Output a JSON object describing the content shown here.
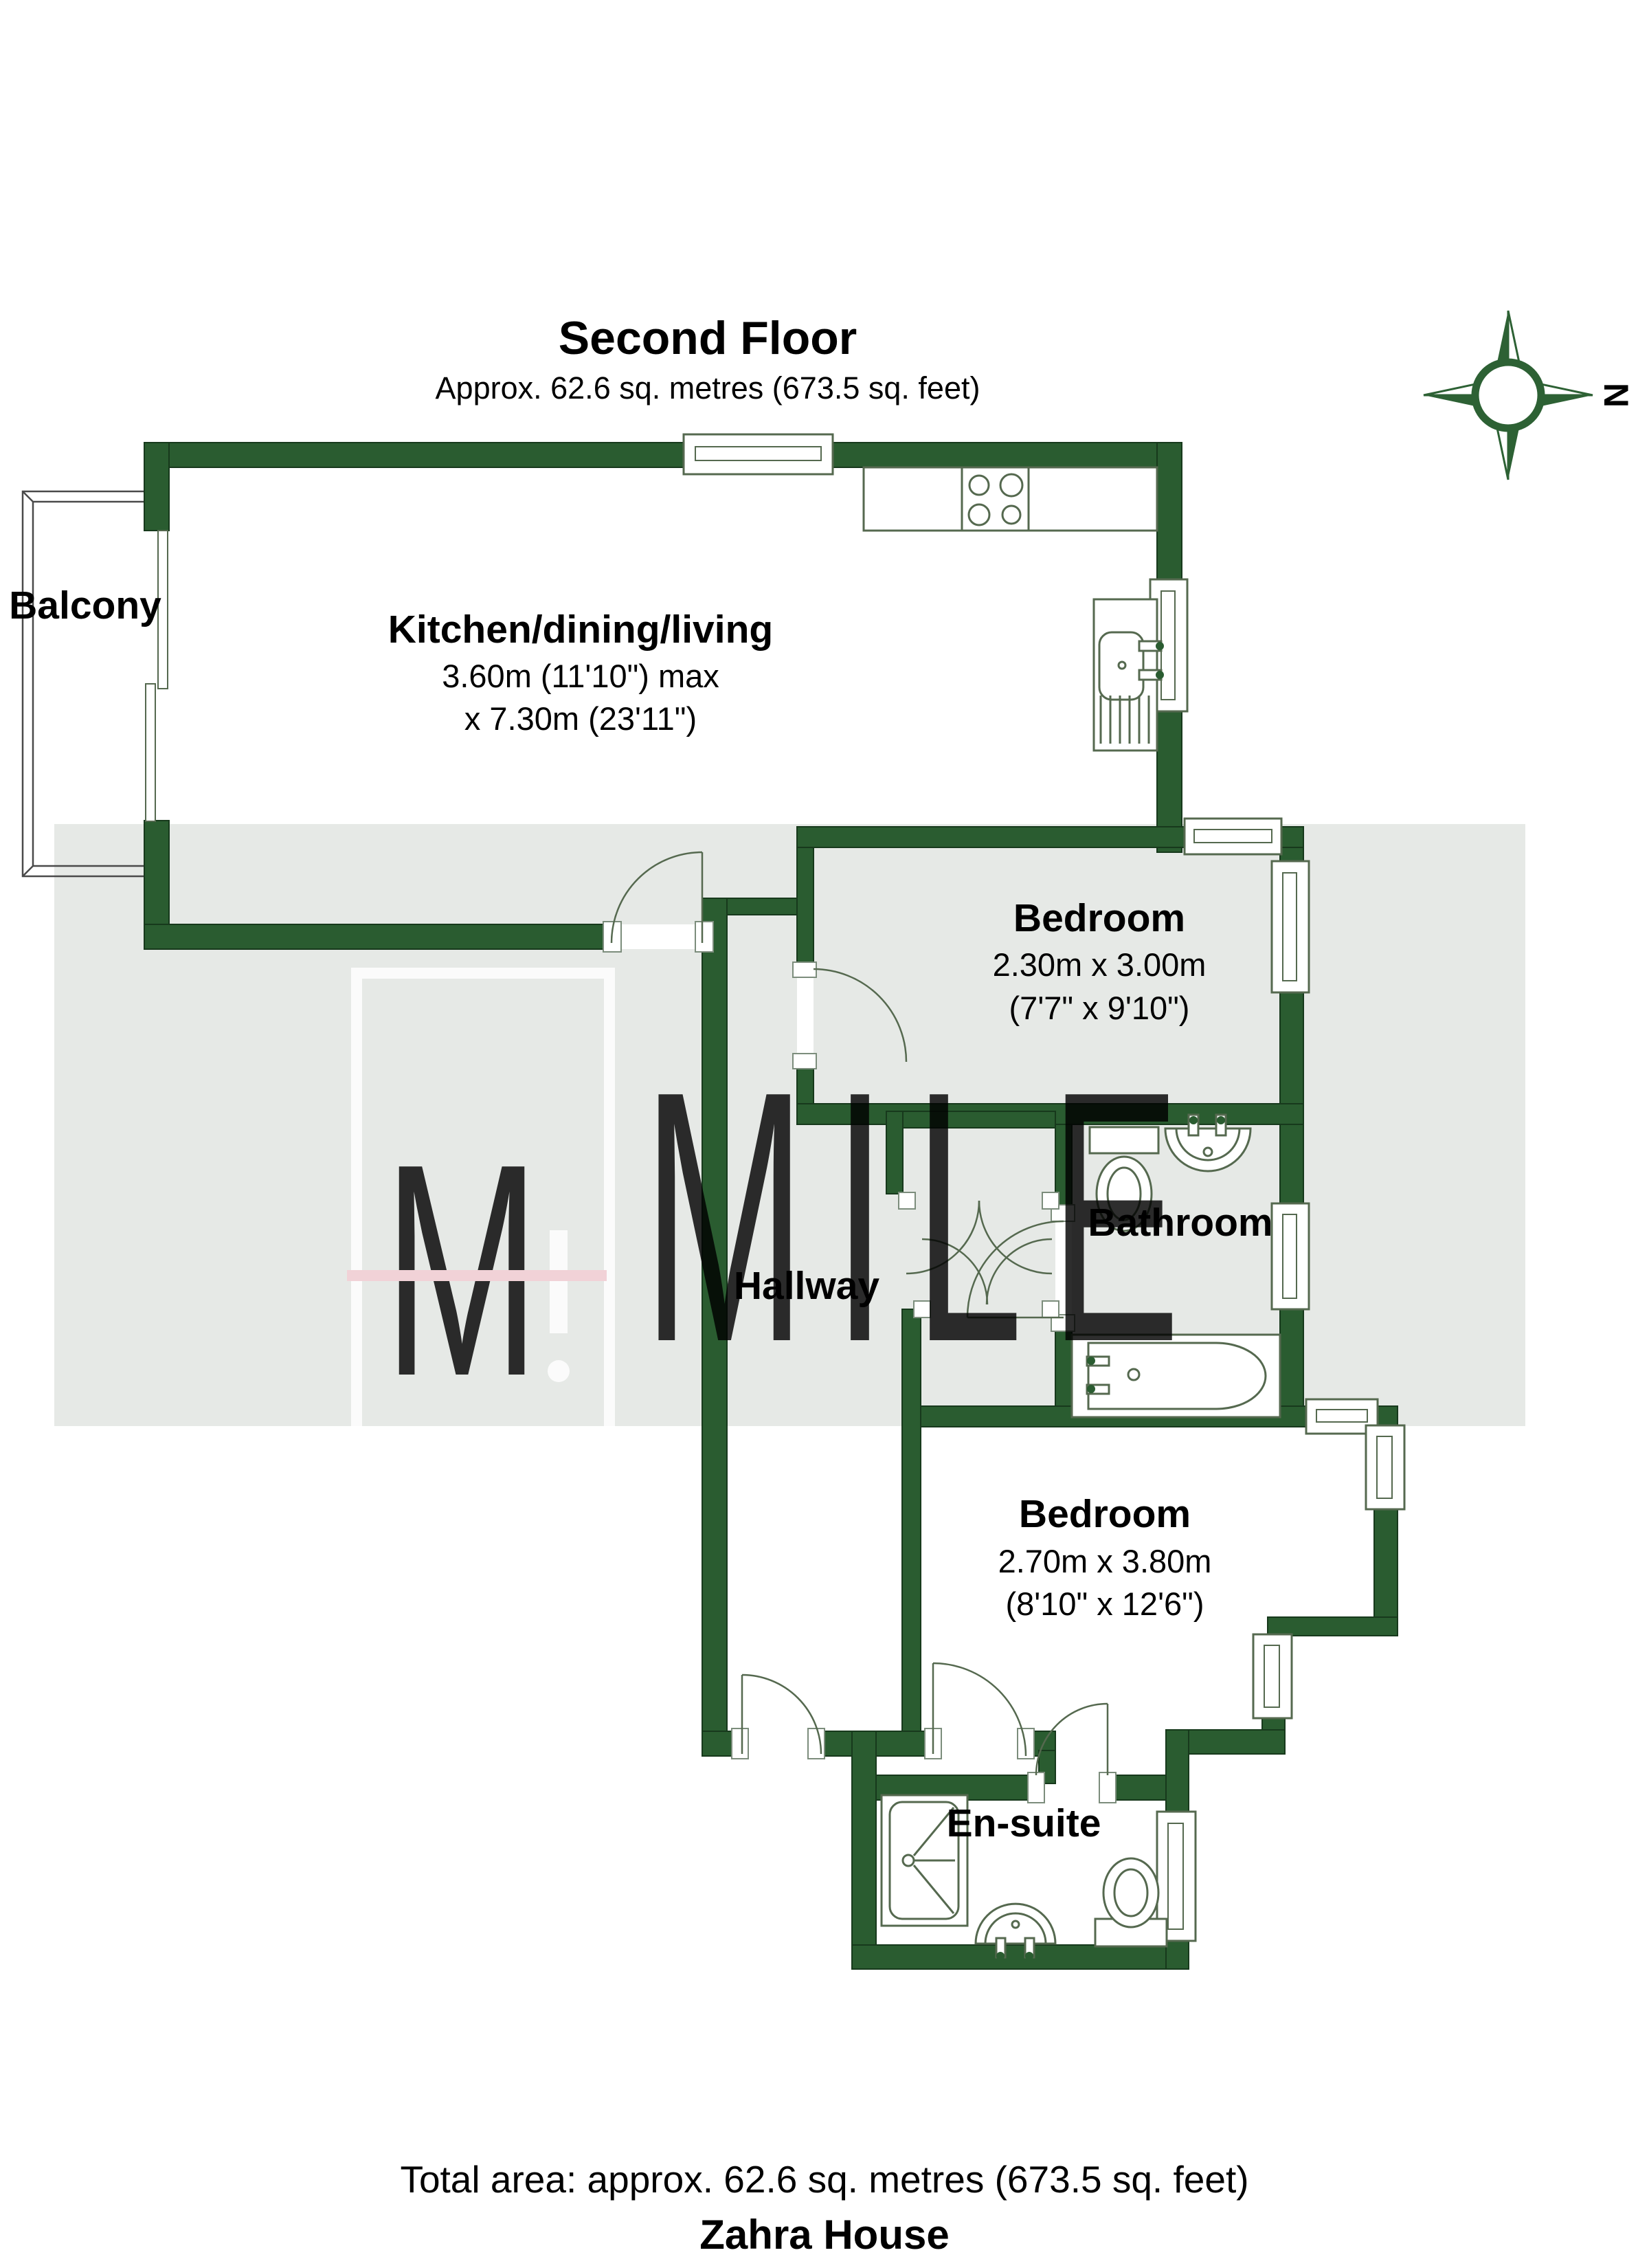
{
  "title": {
    "heading": "Second Floor",
    "subtitle": "Approx. 62.6 sq. metres (673.5 sq. feet)"
  },
  "compass": {
    "north_label": "N"
  },
  "watermark": {
    "monogram_letter": "M",
    "word": "MILE"
  },
  "rooms": {
    "balcony": {
      "name": "Balcony"
    },
    "kitchen": {
      "name": "Kitchen/dining/living",
      "dim1": "3.60m (11'10\") max",
      "dim2": "x 7.30m (23'11\")"
    },
    "bedroom1": {
      "name": "Bedroom",
      "dim1": "2.30m x 3.00m",
      "dim2": "(7'7\" x 9'10\")"
    },
    "bathroom": {
      "name": "Bathroom"
    },
    "hallway": {
      "name": "Hallway"
    },
    "bedroom2": {
      "name": "Bedroom",
      "dim1": "2.70m x 3.80m",
      "dim2": "(8'10\" x 12'6\")"
    },
    "ensuite": {
      "name": "En-suite"
    }
  },
  "footer": {
    "total_area": "Total area: approx. 62.6 sq. metres (673.5 sq. feet)",
    "property_name": "Zahra House"
  },
  "colors": {
    "wall_green": "#2a5c30",
    "floor_band_gray": "#e6e9e6",
    "fixture_line": "#55694f",
    "watermark_pink": "#f3cdd3"
  }
}
